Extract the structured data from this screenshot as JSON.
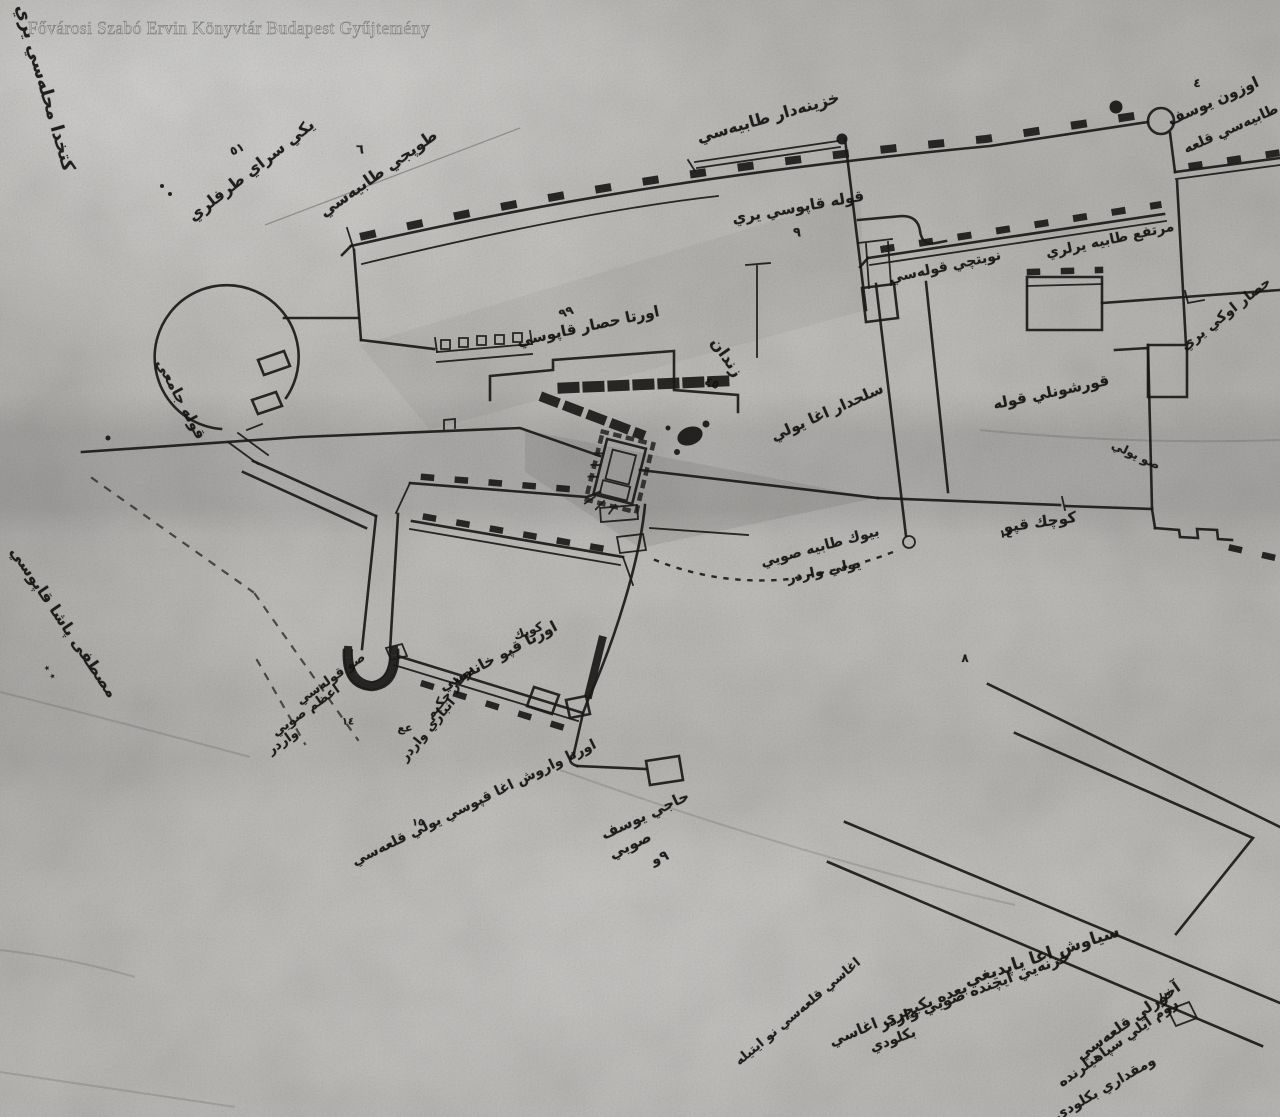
{
  "watermark": {
    "text": "Fővárosi Szabó Ervin Könyvtár Budapest Gyűjtemény"
  },
  "palette": {
    "paper": "#c6c5c2",
    "ink": "#1c1b1a",
    "watermark_gray": "#8a8a88"
  },
  "annotations": [
    {
      "text": "كتخدا محله‌سي يري",
      "x": 45,
      "y": 88,
      "rot": 74,
      "size": 18
    },
    {
      "text": "٥١",
      "x": 237,
      "y": 149,
      "rot": -25,
      "size": 12
    },
    {
      "text": "يكي سراي طرفلري",
      "x": 251,
      "y": 170,
      "rot": -38,
      "size": 16
    },
    {
      "text": "٦",
      "x": 360,
      "y": 150,
      "rot": 0,
      "size": 13
    },
    {
      "text": "طوپجي طابيه‌سي",
      "x": 378,
      "y": 173,
      "rot": -35,
      "size": 16
    },
    {
      "text": "خزينه‌دار طابيه‌سي",
      "x": 768,
      "y": 117,
      "rot": -16,
      "size": 16
    },
    {
      "text": "قوله قاپوسي يري",
      "x": 798,
      "y": 207,
      "rot": -10,
      "size": 15
    },
    {
      "text": "٩",
      "x": 797,
      "y": 233,
      "rot": 0,
      "size": 13
    },
    {
      "text": "نوبتچي قوله‌سي",
      "x": 945,
      "y": 267,
      "rot": -12,
      "size": 14
    },
    {
      "text": "٤",
      "x": 1197,
      "y": 83,
      "rot": 0,
      "size": 12
    },
    {
      "text": "اوزون يوسف",
      "x": 1213,
      "y": 101,
      "rot": -24,
      "size": 15
    },
    {
      "text": "طابيه‌سي قلعه",
      "x": 1231,
      "y": 129,
      "rot": -24,
      "size": 14
    },
    {
      "text": "مرتفع طابيه يرلري",
      "x": 1110,
      "y": 240,
      "rot": -12,
      "size": 14
    },
    {
      "text": "حصار اوكي يري",
      "x": 1226,
      "y": 314,
      "rot": -38,
      "size": 14
    },
    {
      "text": "قوله جامعي",
      "x": 181,
      "y": 399,
      "rot": 62,
      "size": 15
    },
    {
      "text": "اورتا حصار قاپوسي",
      "x": 588,
      "y": 326,
      "rot": -12,
      "size": 15
    },
    {
      "text": "٩٩",
      "x": 566,
      "y": 312,
      "rot": -20,
      "size": 12
    },
    {
      "text": "زندان",
      "x": 727,
      "y": 357,
      "rot": 55,
      "size": 16
    },
    {
      "text": "٤٥",
      "x": 712,
      "y": 383,
      "rot": 20,
      "size": 12
    },
    {
      "text": "سلحدار اغا يولي",
      "x": 827,
      "y": 412,
      "rot": -24,
      "size": 15
    },
    {
      "text": "قورشونلي قوله",
      "x": 1051,
      "y": 392,
      "rot": -12,
      "size": 15
    },
    {
      "text": "صو يولي",
      "x": 1136,
      "y": 455,
      "rot": 25,
      "size": 12
    },
    {
      "text": "١٤",
      "x": 1006,
      "y": 534,
      "rot": 0,
      "size": 11
    },
    {
      "text": "كوچك قپو",
      "x": 1040,
      "y": 522,
      "rot": -8,
      "size": 15
    },
    {
      "text": "بيوك طابيه صويي",
      "x": 820,
      "y": 547,
      "rot": -15,
      "size": 14
    },
    {
      "text": "يولي واردر",
      "x": 824,
      "y": 571,
      "rot": -12,
      "size": 14
    },
    {
      "text": "٨",
      "x": 965,
      "y": 658,
      "rot": 0,
      "size": 12
    },
    {
      "text": "كوپك",
      "x": 528,
      "y": 631,
      "rot": -20,
      "size": 12
    },
    {
      "text": "اورتا قپو خانه‌سي",
      "x": 498,
      "y": 656,
      "rot": -28,
      "size": 15
    },
    {
      "text": "صو قوله‌سي",
      "x": 331,
      "y": 679,
      "rot": -35,
      "size": 13
    },
    {
      "text": "اعظم صويي",
      "x": 306,
      "y": 711,
      "rot": -35,
      "size": 13
    },
    {
      "text": "١٤",
      "x": 348,
      "y": 722,
      "rot": 0,
      "size": 10
    },
    {
      "text": "واردر",
      "x": 283,
      "y": 742,
      "rot": -35,
      "size": 13
    },
    {
      "text": "بونار حكيم",
      "x": 450,
      "y": 692,
      "rot": -50,
      "size": 13
    },
    {
      "text": "عع",
      "x": 405,
      "y": 728,
      "rot": 0,
      "size": 11
    },
    {
      "text": "انباري واردر",
      "x": 428,
      "y": 730,
      "rot": -50,
      "size": 13
    },
    {
      "text": "مصطفى پاشا قاپوسي",
      "x": 64,
      "y": 622,
      "rot": 56,
      "size": 16
    },
    {
      "text": "٭ ٭",
      "x": 50,
      "y": 672,
      "rot": 56,
      "size": 11
    },
    {
      "text": "اورتا واروش اغا قپوسي يولي قلعه‌سي",
      "x": 474,
      "y": 803,
      "rot": -26,
      "size": 14
    },
    {
      "text": "١٥",
      "x": 418,
      "y": 823,
      "rot": 0,
      "size": 10
    },
    {
      "text": "حاجي يوسف",
      "x": 645,
      "y": 815,
      "rot": -25,
      "size": 15
    },
    {
      "text": "صويي",
      "x": 630,
      "y": 845,
      "rot": -25,
      "size": 15
    },
    {
      "text": "٩و",
      "x": 660,
      "y": 858,
      "rot": -20,
      "size": 14
    },
    {
      "text": "سياوش اغا ياپديغي",
      "x": 1042,
      "y": 956,
      "rot": -18,
      "size": 17
    },
    {
      "text": "خزنه‌يي ايچنده صويي واردر",
      "x": 975,
      "y": 990,
      "rot": -20,
      "size": 15
    },
    {
      "text": "بعده يكيچري اغاسي",
      "x": 898,
      "y": 1014,
      "rot": -22,
      "size": 15
    },
    {
      "text": "اغاسي قلعه‌سي نو ايتيله",
      "x": 798,
      "y": 1012,
      "rot": -40,
      "size": 13
    },
    {
      "text": "بكلودي",
      "x": 893,
      "y": 1040,
      "rot": -20,
      "size": 14
    },
    {
      "text": "١٣",
      "x": 1164,
      "y": 997,
      "rot": 0,
      "size": 10
    },
    {
      "text": "آخورلي قلعه‌سي",
      "x": 1128,
      "y": 1021,
      "rot": -35,
      "size": 15
    },
    {
      "text": "روم ايلي سپاهيلرنده",
      "x": 1118,
      "y": 1043,
      "rot": -35,
      "size": 14
    },
    {
      "text": "ومقداري بكلودي",
      "x": 1105,
      "y": 1088,
      "rot": -30,
      "size": 14
    }
  ]
}
